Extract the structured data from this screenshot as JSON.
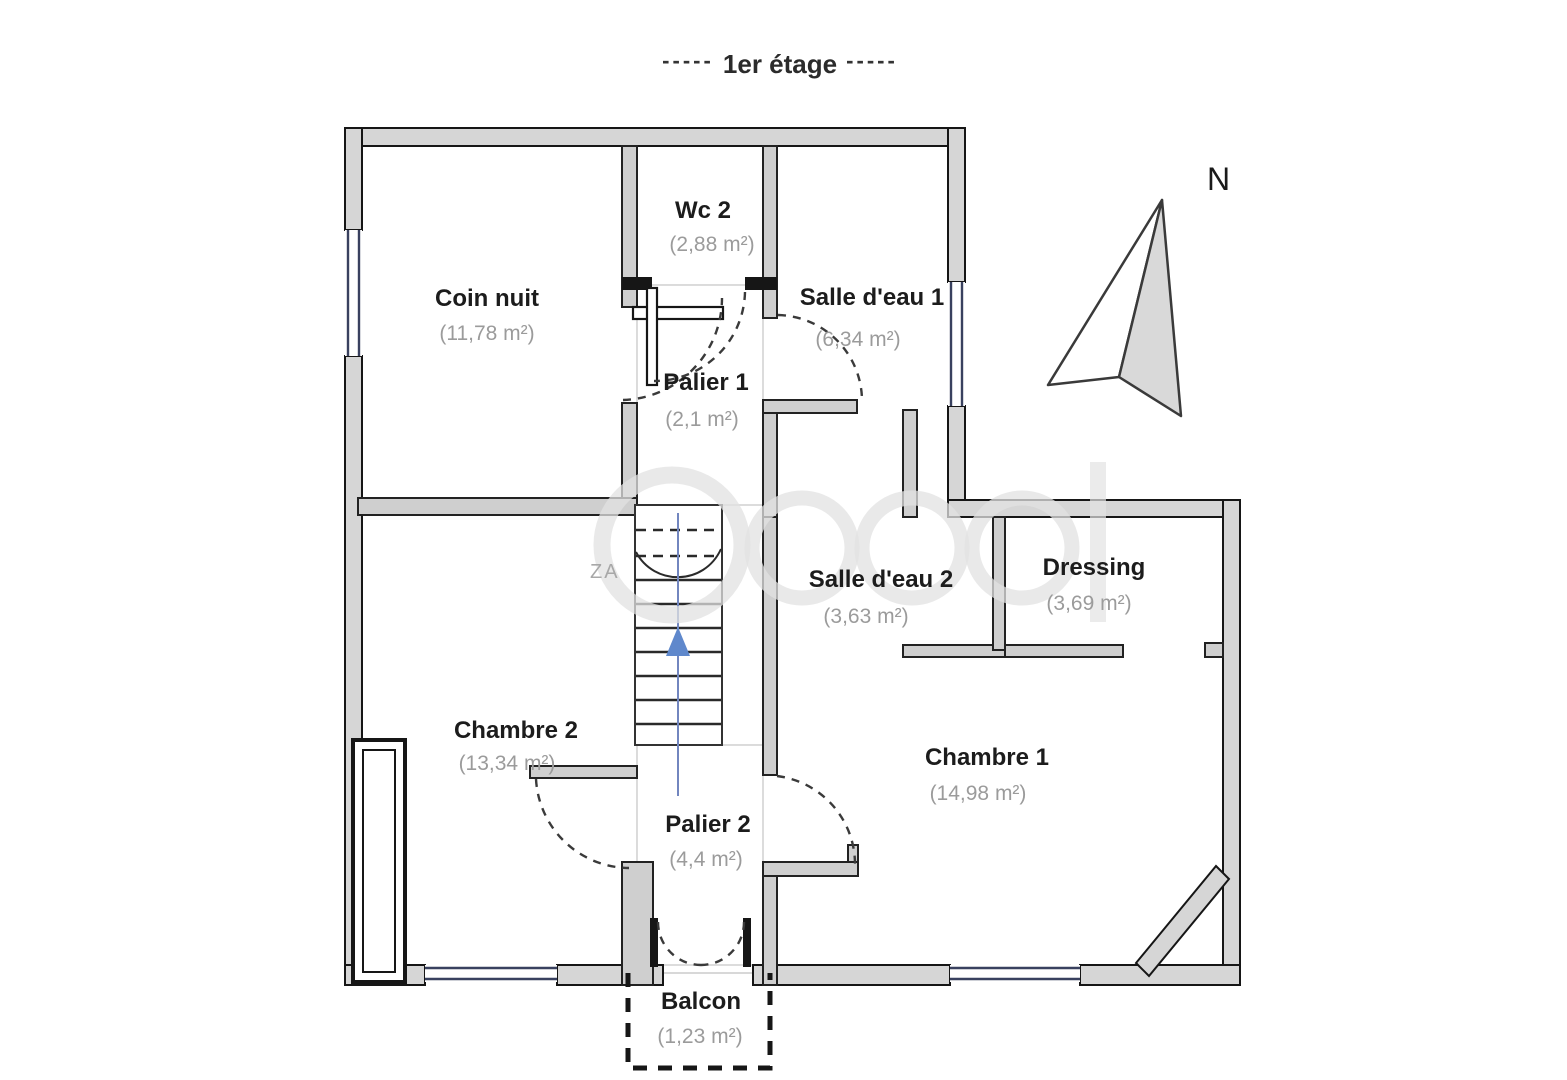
{
  "title": {
    "text": "1er étage",
    "dash_left": "-----",
    "dash_right": "-----"
  },
  "compass": {
    "label": "N"
  },
  "rooms": [
    {
      "id": "coin-nuit",
      "name": "Coin nuit",
      "area": "(11,78 m²)"
    },
    {
      "id": "wc-2",
      "name": "Wc 2",
      "area": "(2,88 m²)"
    },
    {
      "id": "salle-eau-1",
      "name": "Salle d'eau 1",
      "area": "(6,34 m²)"
    },
    {
      "id": "palier-1",
      "name": "Palier 1",
      "area": "(2,1 m²)"
    },
    {
      "id": "salle-eau-2",
      "name": "Salle d'eau 2",
      "area": "(3,63 m²)"
    },
    {
      "id": "dressing",
      "name": "Dressing",
      "area": "(3,69 m²)"
    },
    {
      "id": "chambre-2",
      "name": "Chambre 2",
      "area": "(13,34 m²)"
    },
    {
      "id": "chambre-1",
      "name": "Chambre 1",
      "area": "(14,98 m²)"
    },
    {
      "id": "palier-2",
      "name": "Palier 2",
      "area": "(4,4 m²)"
    },
    {
      "id": "balcon",
      "name": "Balcon",
      "area": "(1,23 m²)"
    }
  ],
  "watermark": {
    "subtext": "ZA"
  },
  "colors": {
    "wall_fill": "#d6d6d6",
    "wall_stroke": "#161616",
    "window": "#39415f",
    "stair_arrow": "#5f88cc",
    "area_text": "#9b9b9b",
    "room_text": "#1c1c1c"
  }
}
